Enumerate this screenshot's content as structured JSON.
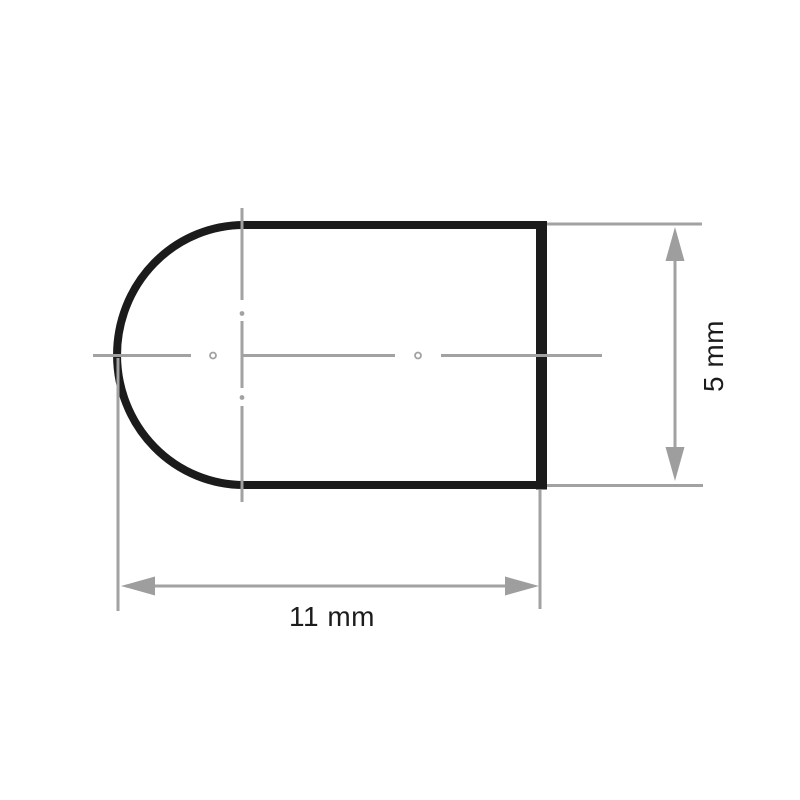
{
  "drawing": {
    "labels": {
      "width": "11 mm",
      "height": "5 mm"
    },
    "colors": {
      "outline": "#1b1b1b",
      "dimension_lines": "#a2a2a2",
      "arrows": "#9e9e9e",
      "text": "#1c1c1c",
      "background": "#ffffff"
    }
  }
}
